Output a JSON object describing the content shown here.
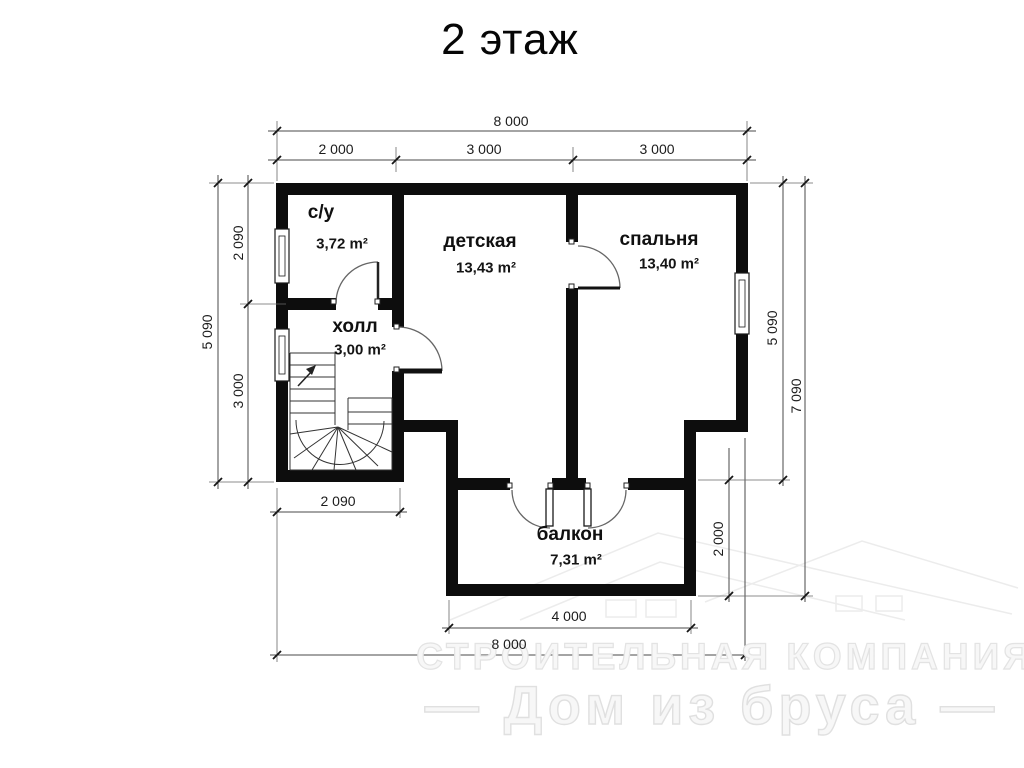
{
  "title": "2 этаж",
  "rooms": {
    "su": {
      "name": "с/у",
      "area": "3,72 m²"
    },
    "detskaya": {
      "name": "детская",
      "area": "13,43 m²"
    },
    "spalnya": {
      "name": "спальня",
      "area": "13,40 m²"
    },
    "holl": {
      "name": "холл",
      "area": "3,00 m²"
    },
    "balkon": {
      "name": "балкон",
      "area": "7,31 m²"
    }
  },
  "dimensions": {
    "top_total": "8 000",
    "top_seg1": "2 000",
    "top_seg2": "3 000",
    "top_seg3": "3 000",
    "left_total": "5 090",
    "left_seg1": "2 090",
    "left_seg2": "3 000",
    "right_main": "5 090",
    "right_total": "7 090",
    "right_balcony": "2 000",
    "bottom_stairs": "2 090",
    "bottom_balcony": "4 000",
    "bottom_total": "8 000"
  },
  "watermark": {
    "line1": "СТРОИТЕЛЬНАЯ КОМПАНИЯ",
    "line2": "— Дом из бруса —"
  }
}
